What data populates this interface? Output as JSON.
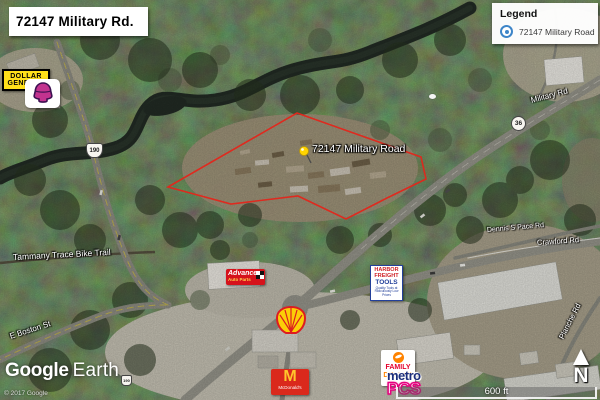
{
  "title_bar": {
    "text": "72147 Military Rd."
  },
  "legend": {
    "heading": "Legend",
    "item": {
      "label": "72147 Military Road"
    }
  },
  "pin": {
    "label": "72147 Military Road"
  },
  "roads": {
    "military": "Military Rd",
    "tammany": "Tammany Trace Bike Trail",
    "crawford": "Crawford Rd",
    "dennis": "Dennis S Pace Rd",
    "boston": "E Boston St",
    "planche": "Planche Rd"
  },
  "shields": {
    "r190": "190",
    "r36": "36"
  },
  "logos": {
    "dollar_general": {
      "line1": "DOLLAR",
      "line2": "GENERAL"
    },
    "advance": {
      "line1": "Advance",
      "line2": "Auto Parts"
    },
    "harbor": {
      "line1": "HARBOR",
      "line2": "FREIGHT",
      "line3": "TOOLS",
      "tagline": "Quality Tools at Ridiculously Low Prices"
    },
    "family_dollar": {
      "line1": "FAMILY",
      "line2": "DOLLAR"
    },
    "metro": {
      "line1": "metro",
      "line2": "PCS"
    },
    "mcdonalds": {
      "arches": "M",
      "name": "McDonald's"
    }
  },
  "attribution": {
    "watermark_google": "Google",
    "watermark_earth": "Earth",
    "copyright": "© 2017 Google"
  },
  "scale": {
    "label": "600 ft"
  },
  "compass": {
    "label": "N"
  },
  "colors": {
    "boundary": "#E3261B",
    "pin": "#FFD400",
    "legend_marker": "#3D85C8"
  }
}
